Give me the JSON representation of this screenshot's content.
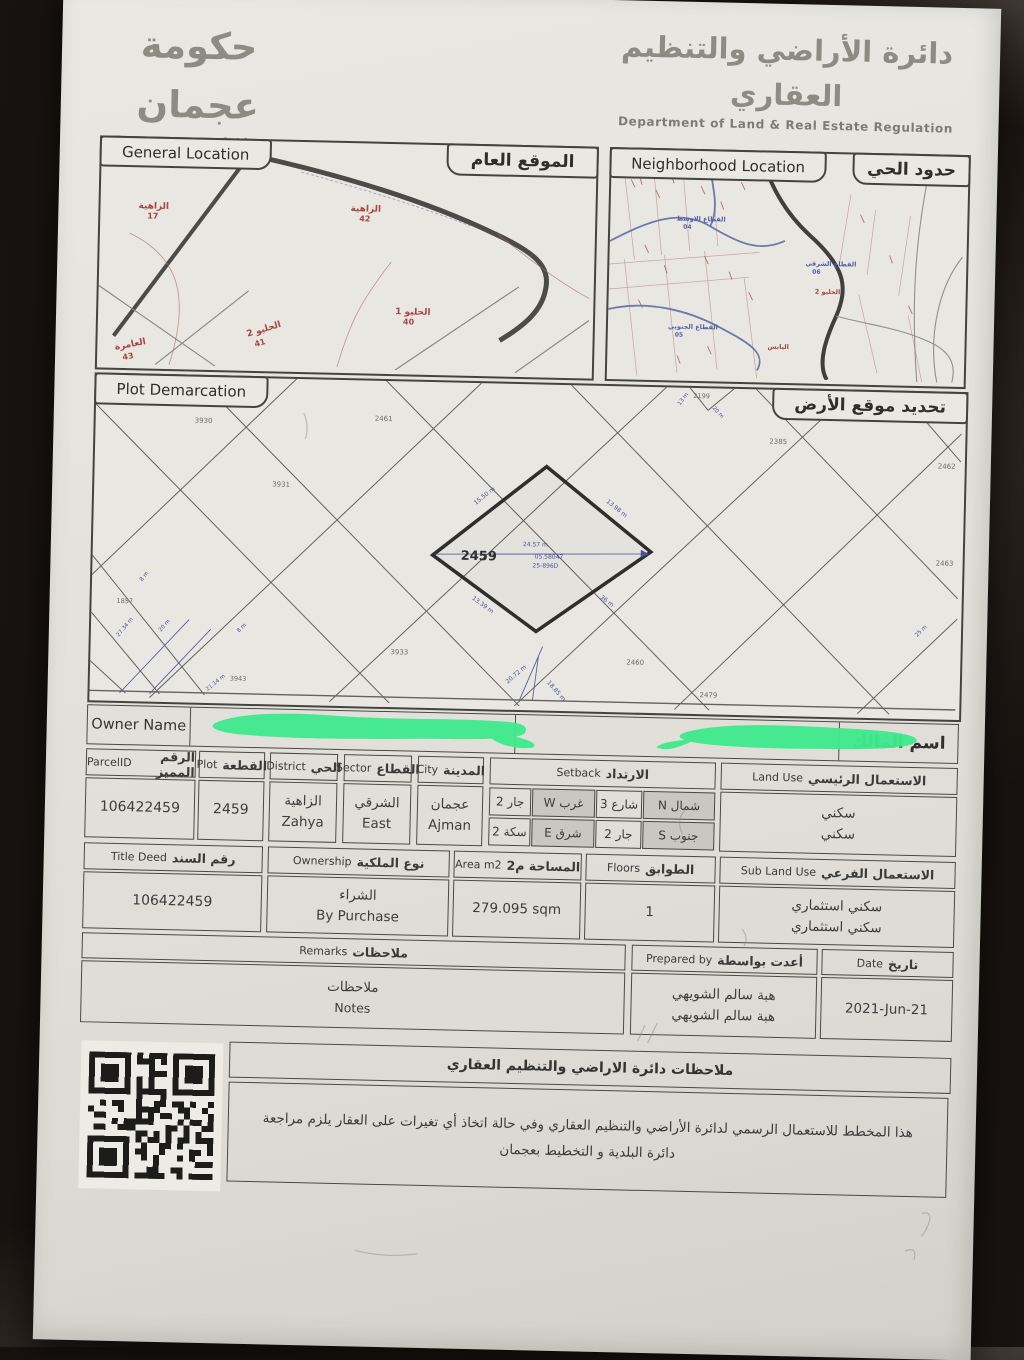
{
  "branding": {
    "gov_ar": "حكومة عجمان",
    "gov_en": "Government of Ajman",
    "dept_ar": "دائرة الأراضي والتنظيم العقاري",
    "dept_en": "Department of Land & Real Estate Regulation"
  },
  "maps": {
    "general": {
      "title_en": "General Location",
      "title_ar": "الموقع العام",
      "areas": [
        {
          "name": "الزاهية",
          "num": "17"
        },
        {
          "name": "الزاهية",
          "num": "42"
        },
        {
          "name": "الحليو 1",
          "num": "40"
        },
        {
          "name": "الحليو 2",
          "num": "41"
        },
        {
          "name": "العامرة",
          "num": "43"
        }
      ]
    },
    "neighborhood": {
      "title_en": "Neighborhood Location",
      "title_ar": "حدود الحي",
      "sectors": [
        {
          "name": "القطاع الشمالي",
          "num": "03"
        },
        {
          "name": "القطاع الاوسط",
          "num": "04"
        },
        {
          "name": "القطاع الشرقي",
          "num": "06"
        },
        {
          "name": "القطاع الجنوبي",
          "num": "05"
        }
      ],
      "areas": [
        {
          "name": "الحليو 2"
        },
        {
          "name": "اليابس"
        }
      ]
    },
    "demarcation": {
      "title_en": "Plot Demarcation",
      "title_ar": "تحديد موقع الأرض",
      "plot_number": "2459",
      "plot_annotations": [
        "24.57 m",
        "05.58047",
        "25-896D"
      ],
      "edge_dims": [
        "15.50 m",
        "13.98 m",
        "36 m",
        "13.39 m"
      ],
      "parcels": [
        "3930",
        "2461",
        "2199",
        "2385",
        "2462",
        "3931",
        "2463",
        "1857",
        "3933",
        "2460",
        "2479",
        "3943"
      ],
      "street_dims": [
        "20 m",
        "13 m",
        "20.72 m",
        "18.85 m",
        "27.34 m",
        "21.14 m",
        "25 m",
        "20 m",
        "8 m",
        "8 m"
      ]
    }
  },
  "owner": {
    "label_en": "Owner Name",
    "label_ar": "اسم المالك"
  },
  "fields": {
    "parcel_id": {
      "en": "ParcelID",
      "ar": "الرقم المميز",
      "value": "106422459"
    },
    "plot": {
      "en": "Plot",
      "ar": "القطعة",
      "value": "2459"
    },
    "district": {
      "en": "District",
      "ar": "الحي",
      "value_ar": "الزاهية",
      "value_en": "Zahya"
    },
    "sector": {
      "en": "Sector",
      "ar": "القطاع",
      "value_ar": "الشرقي",
      "value_en": "East"
    },
    "city": {
      "en": "City",
      "ar": "المدينة",
      "value_ar": "عجمان",
      "value_en": "Ajman"
    },
    "setback": {
      "en": "Setback",
      "ar": "الارتداد",
      "rows": [
        [
          "جار 2",
          "غرب W",
          "شارع 3",
          "شمال N"
        ],
        [
          "سكة 2",
          "شرق E",
          "جار 2",
          "جنوب S"
        ]
      ]
    },
    "land_use": {
      "en": "Land Use",
      "ar": "الاستعمال الرئيسي",
      "values": [
        "سكني",
        "سكني"
      ]
    },
    "title_deed": {
      "en": "Title Deed",
      "ar": "رقم السند",
      "value": "106422459"
    },
    "ownership": {
      "en": "Ownership",
      "ar": "نوع الملكية",
      "value_ar": "الشراء",
      "value_en": "By Purchase"
    },
    "area": {
      "en": "Area m2",
      "ar": "المساحة م2",
      "value": "279.095 sqm"
    },
    "floors": {
      "en": "Floors",
      "ar": "الطوابق",
      "value": "1"
    },
    "sub_land_use": {
      "en": "Sub Land Use",
      "ar": "الاستعمال الفرعي",
      "values": [
        "سكني استثماري",
        "سكني استثماري"
      ]
    },
    "remarks": {
      "en": "Remarks",
      "ar": "ملاحظات",
      "value_ar": "ملاحظات",
      "value_en": "Notes"
    },
    "prepared_by": {
      "en": "Prepared by",
      "ar": "أعدت بواسطة",
      "values": [
        "هبة سالم الشويهي",
        "هبة سالم الشويهي"
      ]
    },
    "date": {
      "en": "Date",
      "ar": "تاريخ",
      "value": "2021-Jun-21"
    }
  },
  "footer": {
    "notes_title": "ملاحظات دائرة الاراضي والتنظيم العقاري",
    "notes_body": "هذا المخطط للاستعمال الرسمي لدائرة الأراضي والتنظيم العقاري وفي حالة اتخاذ أي تغيرات على العقار يلزم مراجعة دائرة البلدية و التخطيط بعجمان"
  },
  "colors": {
    "paper": "#e4e2dc",
    "border": "#3f3f3d",
    "map_label_red": "#a84440",
    "map_label_blue": "#4d5fa8",
    "redaction_green": "#3fe98d"
  }
}
